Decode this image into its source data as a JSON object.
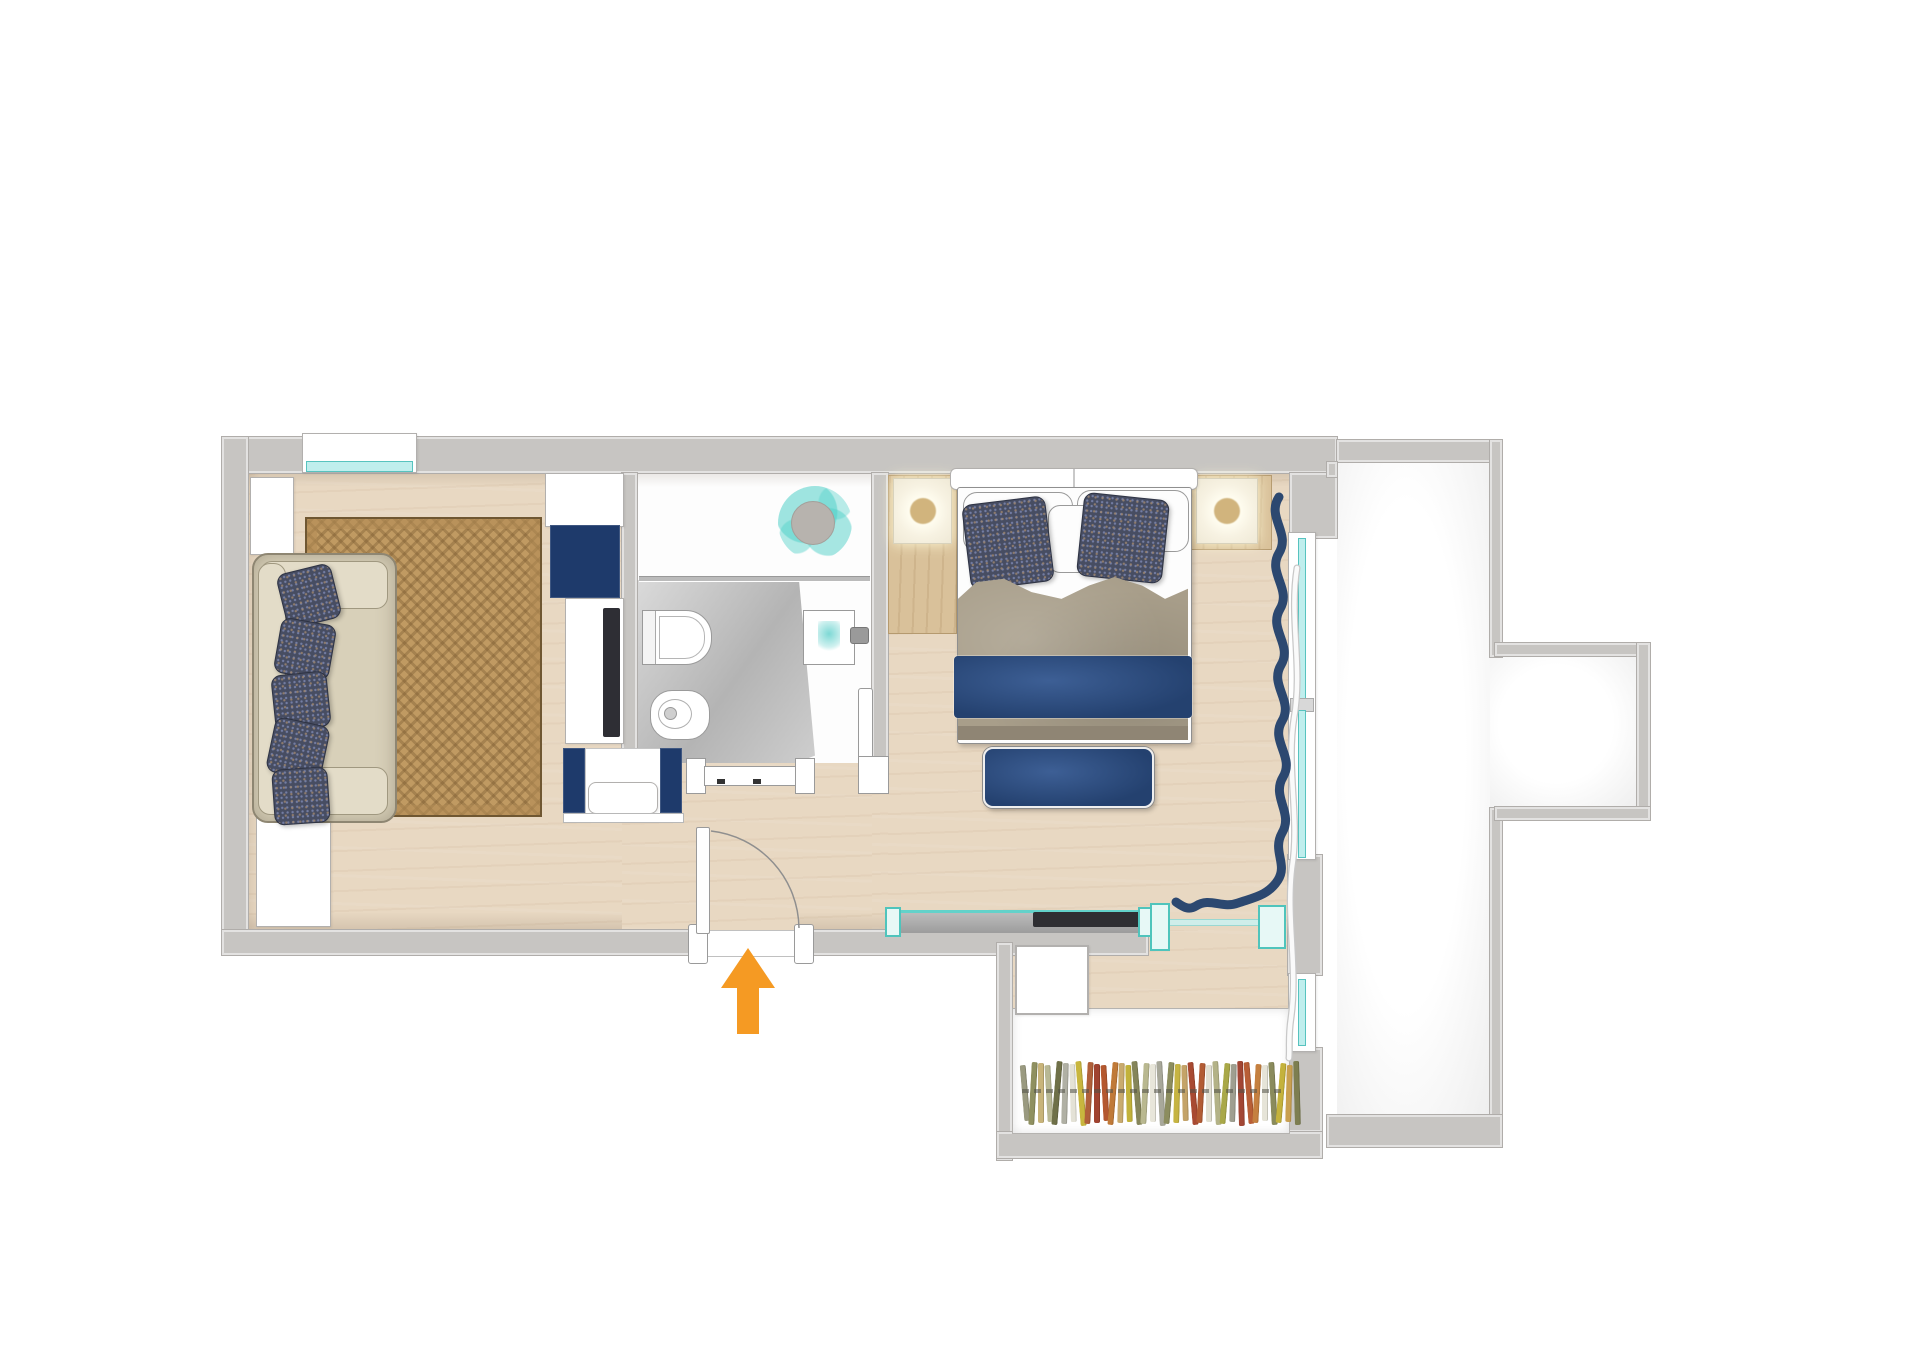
{
  "palette": {
    "wall": "#c7c5c2",
    "wall_edge": "#b0adaa",
    "wood": "#e8d8c2",
    "rug": "#c09a62",
    "navy": "#1e3a6b",
    "navy_soft": "#24416f",
    "teal": "#63d2ca",
    "teal_glass": "#bfeeed",
    "taupe": "#a89e8a",
    "pillow": "#474d62",
    "sofa": "#d8d0b9",
    "orange": "#f59a23"
  },
  "entry": {
    "arrow_direction": "up",
    "arrow_color": "#f59a23"
  },
  "wardrobe": {
    "clothes_colors": [
      "#9a9a80",
      "#8f9060",
      "#c8b47a",
      "#b8b894",
      "#6f7048",
      "#b0b0a4",
      "#e4e2d6",
      "#c8b63e",
      "#b0603a",
      "#a04330",
      "#b4582f",
      "#c07a38",
      "#c9ab6e",
      "#c2b23a",
      "#85855a",
      "#b9b890",
      "#e8e6da",
      "#a8a89a",
      "#8c8d5e",
      "#c6b442",
      "#c4a368",
      "#a84a32",
      "#b25c34",
      "#e2e0d2",
      "#b3b287",
      "#a9a848",
      "#9f9f90",
      "#a24634",
      "#b85e36",
      "#c58040",
      "#e6e4d8",
      "#8a8b5c",
      "#c4b23c",
      "#c9a050",
      "#7d7e50"
    ]
  },
  "decor": {
    "curtain_ribbon_path": "M1279 497 C 1266 517 1291 533 1279 553 C 1267 573 1292 589 1280 609 C 1268 629 1293 645 1281 665 C 1269 685 1294 701 1282 721 C 1270 741 1295 757 1283 777 C 1271 797 1294 813 1282 833 C 1272 851 1288 864 1278 880 C 1268 896 1252 898 1238 903 C 1222 909 1210 897 1196 906 C 1188 911 1182 906 1176 902",
    "sheer_curtain_underlay_path": "M1297 568 C 1289 618 1303 668 1294 718 C 1286 768 1300 818 1292 868 C 1286 918 1298 968 1291 1018 C 1288 1038 1290 1050 1289 1058",
    "sheer_curtain_path": "M1297 568 C 1289 618 1303 668 1294 718 C 1286 768 1300 818 1292 868 C 1286 918 1298 968 1291 1018 C 1288 1038 1290 1050 1289 1058",
    "door_swing_path": "M711 831 A 99 99 0 0 1 799 928"
  }
}
